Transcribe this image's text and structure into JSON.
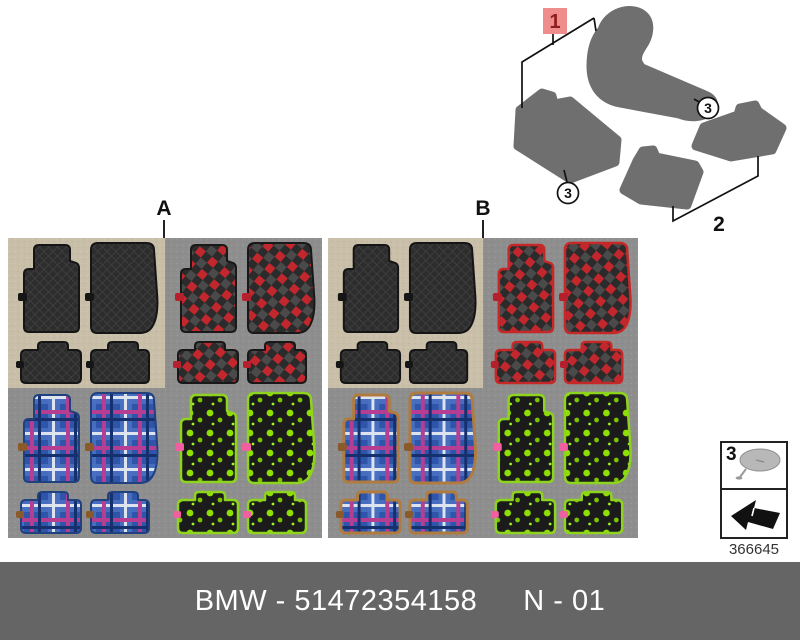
{
  "diagram": {
    "callouts": {
      "one": "1",
      "two": "2",
      "three_right": "3",
      "three_left": "3"
    },
    "highlight_color": "#ef8c8c"
  },
  "variants": {
    "a": "A",
    "b": "B"
  },
  "legend": {
    "item_number": "3",
    "figure_number": "366645"
  },
  "footer": {
    "part_label": "BMW - 51472354158",
    "page_label": "N - 01",
    "bar_color": "#656565"
  },
  "colors": {
    "beige_backing": "#c9bfa9",
    "grey_backing": "#8e8e8e",
    "mat_black": "#2d2d2d",
    "checker_red": "#c1272d",
    "plaid_blue": "#2e55aa",
    "dot_green": "#8ee000",
    "trim_red": "#c62828",
    "trim_tan": "#b07b3e",
    "trim_green": "#8ed41e",
    "tag_pink": "#f25fa0",
    "diagram_grey": "#6f6f6f"
  }
}
